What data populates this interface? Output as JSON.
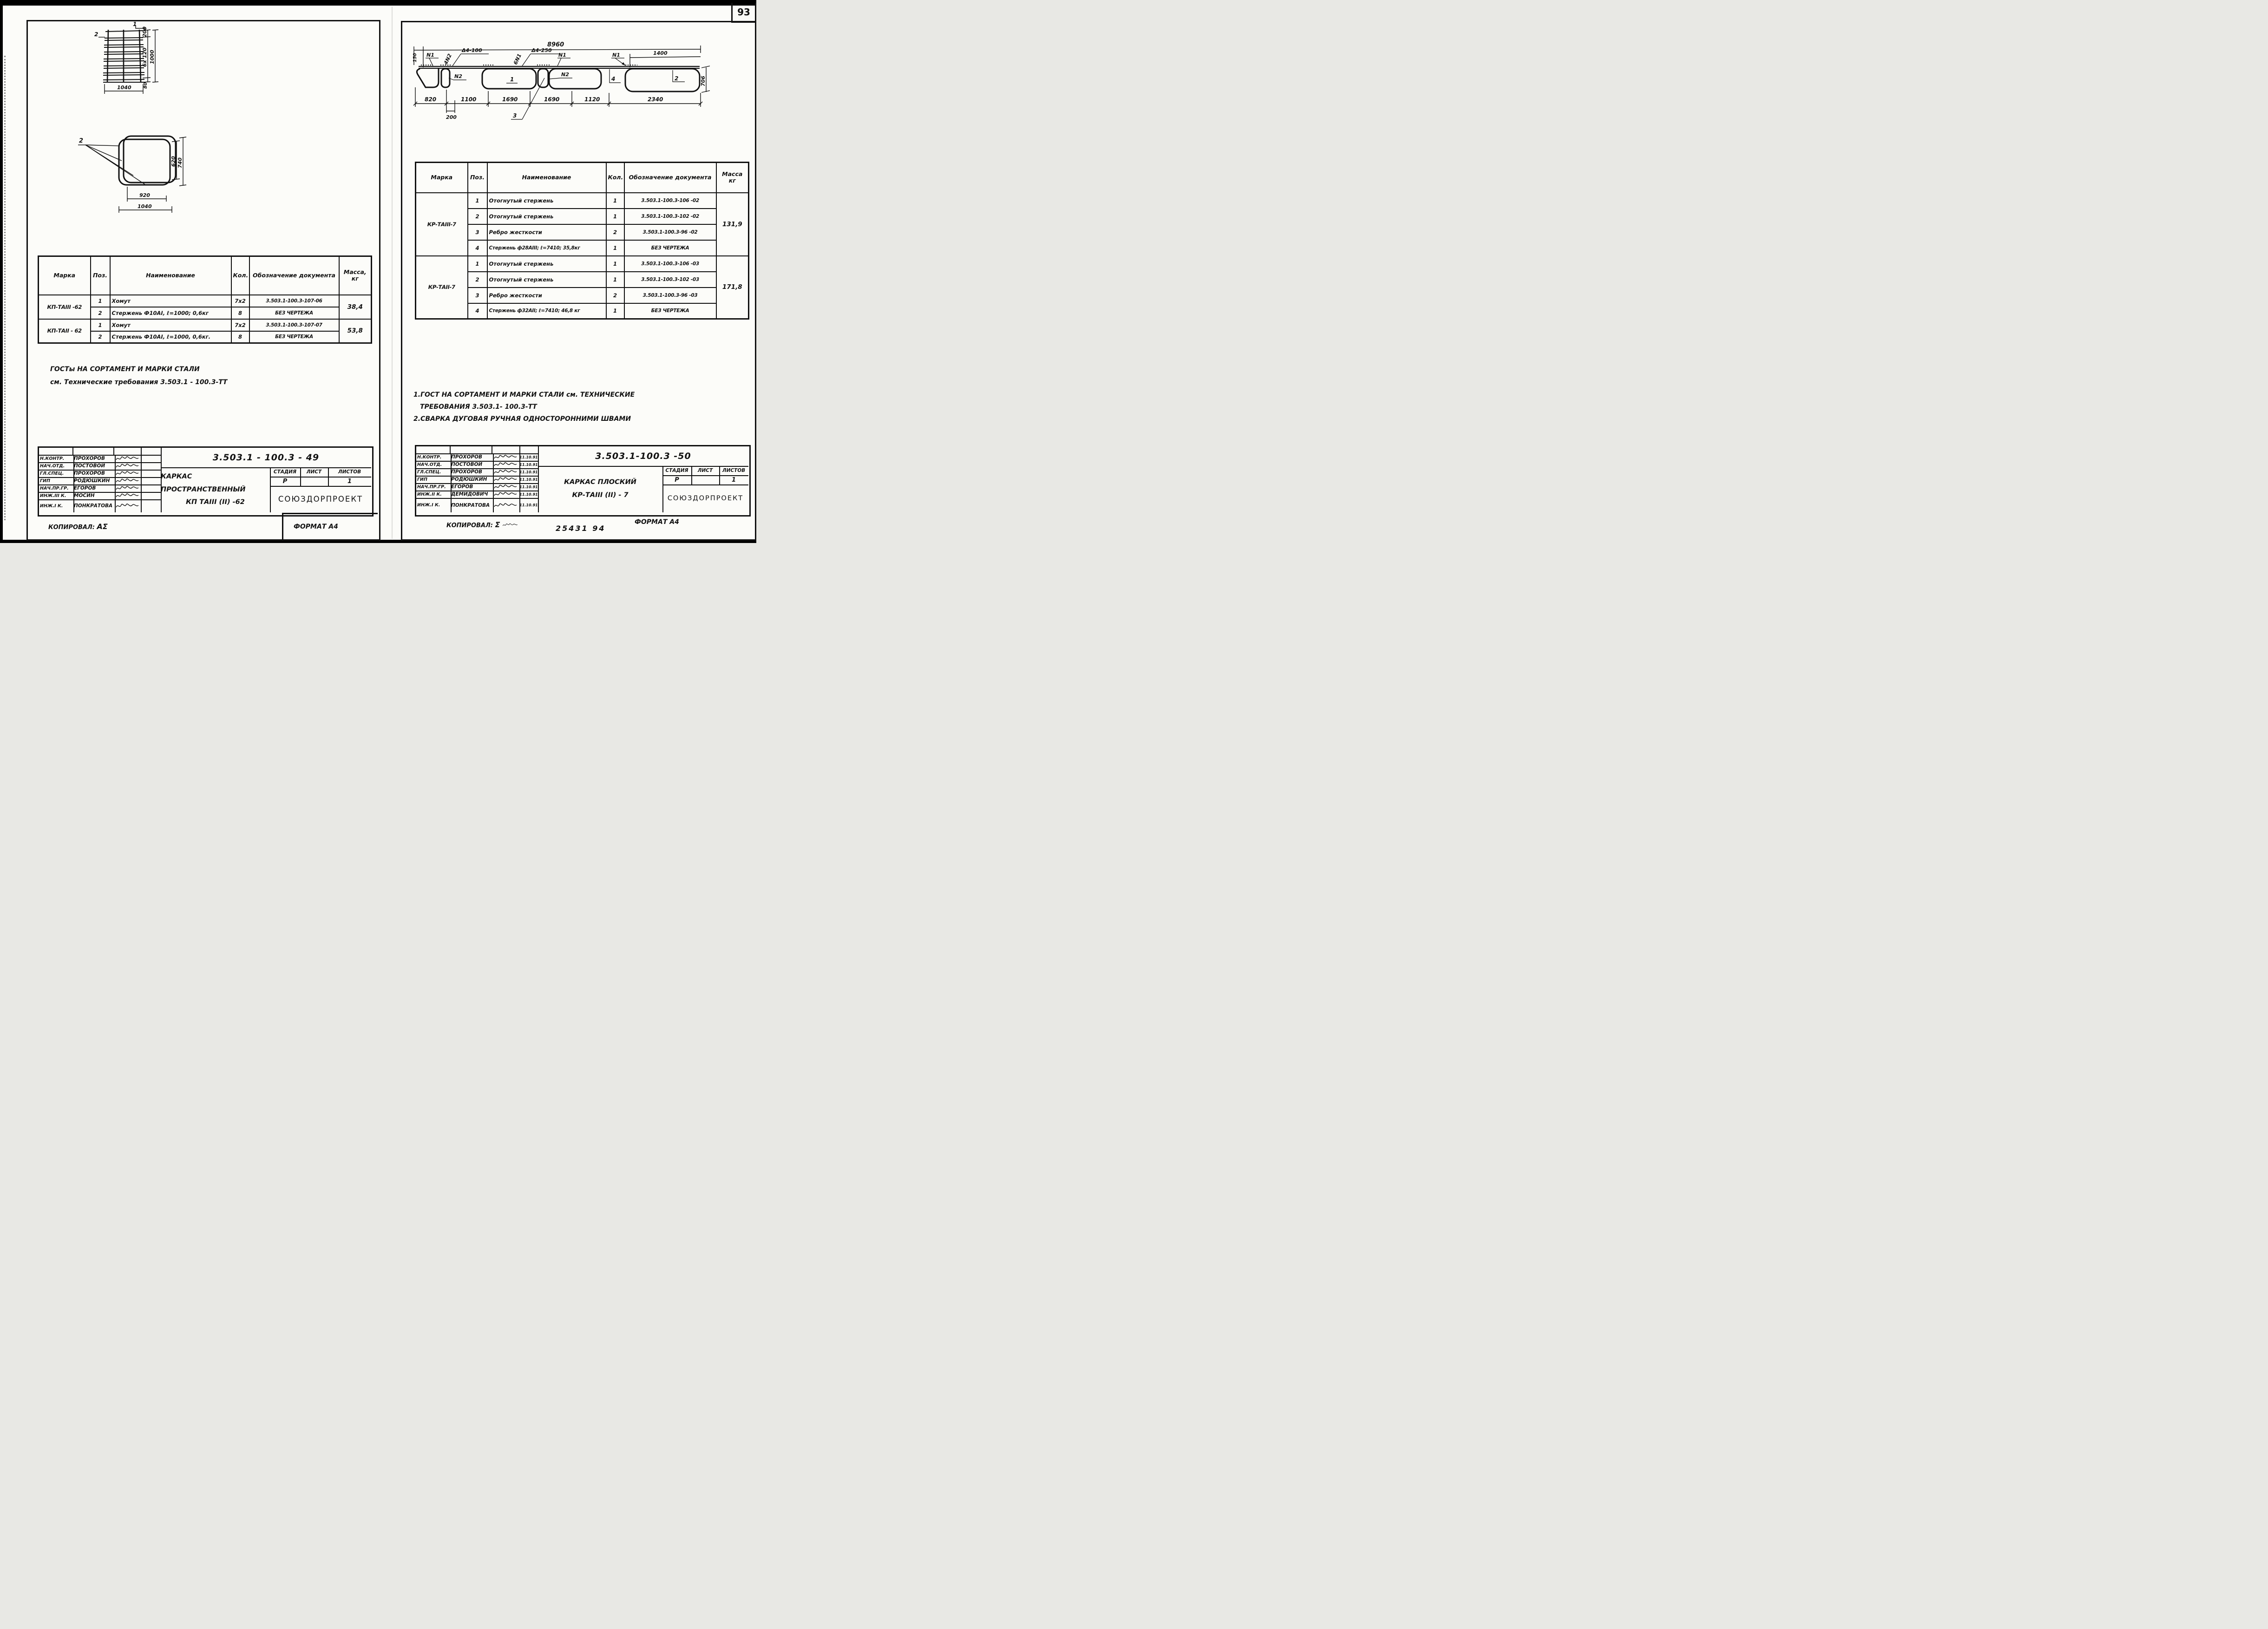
{
  "scan": {
    "page_number": "93"
  },
  "left_page": {
    "drawing_top": {
      "pos_label_1": "1",
      "pos_label_2": "2",
      "dim_200": "200",
      "dim_6x120": "6x 120",
      "dim_1000": "1000",
      "dim_80": "80",
      "dim_1040": "1040"
    },
    "drawing_hoop": {
      "pos_label_2": "2",
      "dim_620": "620",
      "dim_740": "740",
      "dim_920": "920",
      "dim_1040": "1040"
    },
    "table": {
      "headers": [
        "Марка",
        "Поз.",
        "Наименование",
        "Кол.",
        "Обозначение документа",
        "Масса, кг"
      ],
      "groups": [
        {
          "marka": "КП-ТАIII -62",
          "mass": "38,4",
          "rows": [
            {
              "pos": "1",
              "name": "Хомут",
              "qty": "7x2",
              "doc": "3.503.1-100.3-107-06"
            },
            {
              "pos": "2",
              "name": "Стержень Ф10АI, ℓ=1000; 0,6кг",
              "qty": "8",
              "doc": "БЕЗ ЧЕРТЕЖА"
            }
          ]
        },
        {
          "marka": "КП-ТАII - 62",
          "mass": "53,8",
          "rows": [
            {
              "pos": "1",
              "name": "Хомут",
              "qty": "7x2",
              "doc": "3.503.1-100.3-107-07"
            },
            {
              "pos": "2",
              "name": "Стержень Ф10АI, ℓ=1000, 0,6кг.",
              "qty": "8",
              "doc": "БЕЗ ЧЕРТЕЖА"
            }
          ]
        }
      ]
    },
    "notes": {
      "line1": "ГОСТы  НА  СОРТАМЕНТ  И  МАРКИ   СТАЛИ",
      "line2": "см. Технические   требования      3.503.1 - 100.3-ТТ"
    },
    "title_block": {
      "rows": [
        {
          "role": "Н.КОНТР.",
          "name": "ПРОХОРОВ"
        },
        {
          "role": "НАЧ.ОТД.",
          "name": "ПОСТОВОЙ"
        },
        {
          "role": "ГЛ.СПЕЦ.",
          "name": "ПРОХОРОВ"
        },
        {
          "role": "ГИП",
          "name": "РОДЮШКИН"
        },
        {
          "role": "НАЧ.ПР.ГР.",
          "name": "ЕГОРОВ"
        },
        {
          "role": "ИНЖ.III К.",
          "name": "МОСИН"
        },
        {
          "role": "ИНЖ.I К.",
          "name": "ПОНКРАТОВА"
        }
      ],
      "doc_number": "3.503.1 - 100.3 - 49",
      "title_line1": "КАРКАС  ПРОСТРАНСТВЕННЫЙ",
      "title_line2": "КП ТАIII (II) -62",
      "stage_label": "СТАДИЯ",
      "sheet_label": "ЛИСТ",
      "sheets_label": "ЛИСТОВ",
      "stage_value": "Р",
      "sheet_value": "",
      "sheets_value": "1",
      "org": "СОЮЗДОРПРОЕКТ"
    },
    "footer": {
      "copied_label": "КОПИРОВАЛ:",
      "copied_sig": "ΑΣ",
      "format_label": "ФОРМАТ А4"
    }
  },
  "right_page": {
    "drawing": {
      "dim_8960": "8960",
      "dim_150": "150",
      "dim_1400": "1400",
      "dim_706": "706",
      "dim_820": "820",
      "dim_1100": "1100",
      "dim_1690a": "1690",
      "dim_1690b": "1690",
      "dim_1120": "1120",
      "dim_2340": "2340",
      "dim_200": "200",
      "label_n1a": "N1",
      "label_4n2": "4N2",
      "label_d4_100": "Δ4-100",
      "label_6n1": "6N1",
      "label_d4_250": "Δ4-250",
      "label_n1b": "N1",
      "label_n1c": "N1",
      "label_n2a": "N2",
      "label_n2b": "N2",
      "pos_1": "1",
      "pos_2": "2",
      "pos_3": "3",
      "pos_4": "4"
    },
    "table": {
      "headers": [
        "Марка",
        "Поз.",
        "Наименование",
        "Кол.",
        "Обозначение документа",
        "Масса кг"
      ],
      "groups": [
        {
          "marka": "КР-ТАIII-7",
          "mass": "131,9",
          "rows": [
            {
              "pos": "1",
              "name": "Отогнутый стержень",
              "qty": "1",
              "doc": "3.503.1-100.3-106 -02"
            },
            {
              "pos": "2",
              "name": "Отогнутый стержень",
              "qty": "1",
              "doc": "3.503.1-100.3-102 -02"
            },
            {
              "pos": "3",
              "name": "Ребро жесткости",
              "qty": "2",
              "doc": "3.503.1-100.3-96 -02"
            },
            {
              "pos": "4",
              "name": "Стержень ф28АIII; ℓ=7410; 35,8кг",
              "qty": "1",
              "doc": "БЕЗ ЧЕРТЕЖА"
            }
          ]
        },
        {
          "marka": "КР-ТАII-7",
          "mass": "171,8",
          "rows": [
            {
              "pos": "1",
              "name": "Отогнутый стержень",
              "qty": "1",
              "doc": "3.503.1-100.3-106 -03"
            },
            {
              "pos": "2",
              "name": "Отогнутый стержень",
              "qty": "1",
              "doc": "3.503.1-100.3-102 -03"
            },
            {
              "pos": "3",
              "name": "Ребро жесткости",
              "qty": "2",
              "doc": "3.503.1-100.3-96 -03"
            },
            {
              "pos": "4",
              "name": "Стержень ф32АII; ℓ=7410; 46,8 кг",
              "qty": "1",
              "doc": "БЕЗ ЧЕРТЕЖА"
            }
          ]
        }
      ]
    },
    "notes": {
      "line1": "1.ГОСТ  НА  СОРТАМЕНТ  И МАРКИ  СТАЛИ  см. ТЕХНИЧЕСКИЕ",
      "line2": "ТРЕБОВАНИЯ   3.503.1- 100.3-ТТ",
      "line3": "2.СВАРКА   ДУГОВАЯ  РУЧНАЯ    ОДНОСТОРОННИМИ   ШВАМИ"
    },
    "title_block": {
      "rows": [
        {
          "role": "Н.КОНТР.",
          "name": "ПРОХОРОВ",
          "date": "11.10.91"
        },
        {
          "role": "НАЧ.ОТД.",
          "name": "ПОСТОВОЙ",
          "date": "11.10.91"
        },
        {
          "role": "ГЛ.СПЕЦ.",
          "name": "ПРОХОРОВ",
          "date": "11.10.91"
        },
        {
          "role": "ГИП",
          "name": "РОДЮШКИН",
          "date": "11.10.91"
        },
        {
          "role": "НАЧ.ПР.ГР.",
          "name": "ЕГОРОВ",
          "date": "11.10.91"
        },
        {
          "role": "ИНЖ.II К.",
          "name": "ДЕМИДОВИЧ",
          "date": "11.10.91"
        },
        {
          "role": "ИНЖ.I К.",
          "name": "ПОНКРАТОВА",
          "date": "11.10.91"
        }
      ],
      "doc_number": "3.503.1-100.3 -50",
      "title_line1": "КАРКАС     ПЛОСКИЙ",
      "title_line2": "КР-ТАIII (II) - 7",
      "stage_label": "СТАДИЯ",
      "sheet_label": "ЛИСТ",
      "sheets_label": "ЛИСТОВ",
      "stage_value": "Р",
      "sheet_value": "",
      "sheets_value": "1",
      "org": "СОЮЗДОРПРОЕКТ"
    },
    "footer": {
      "copied_label": "КОПИРОВАЛ:",
      "copied_sig": "Σ",
      "stamp": "25431   94",
      "format_label": "ФОРМАТ А4"
    }
  }
}
